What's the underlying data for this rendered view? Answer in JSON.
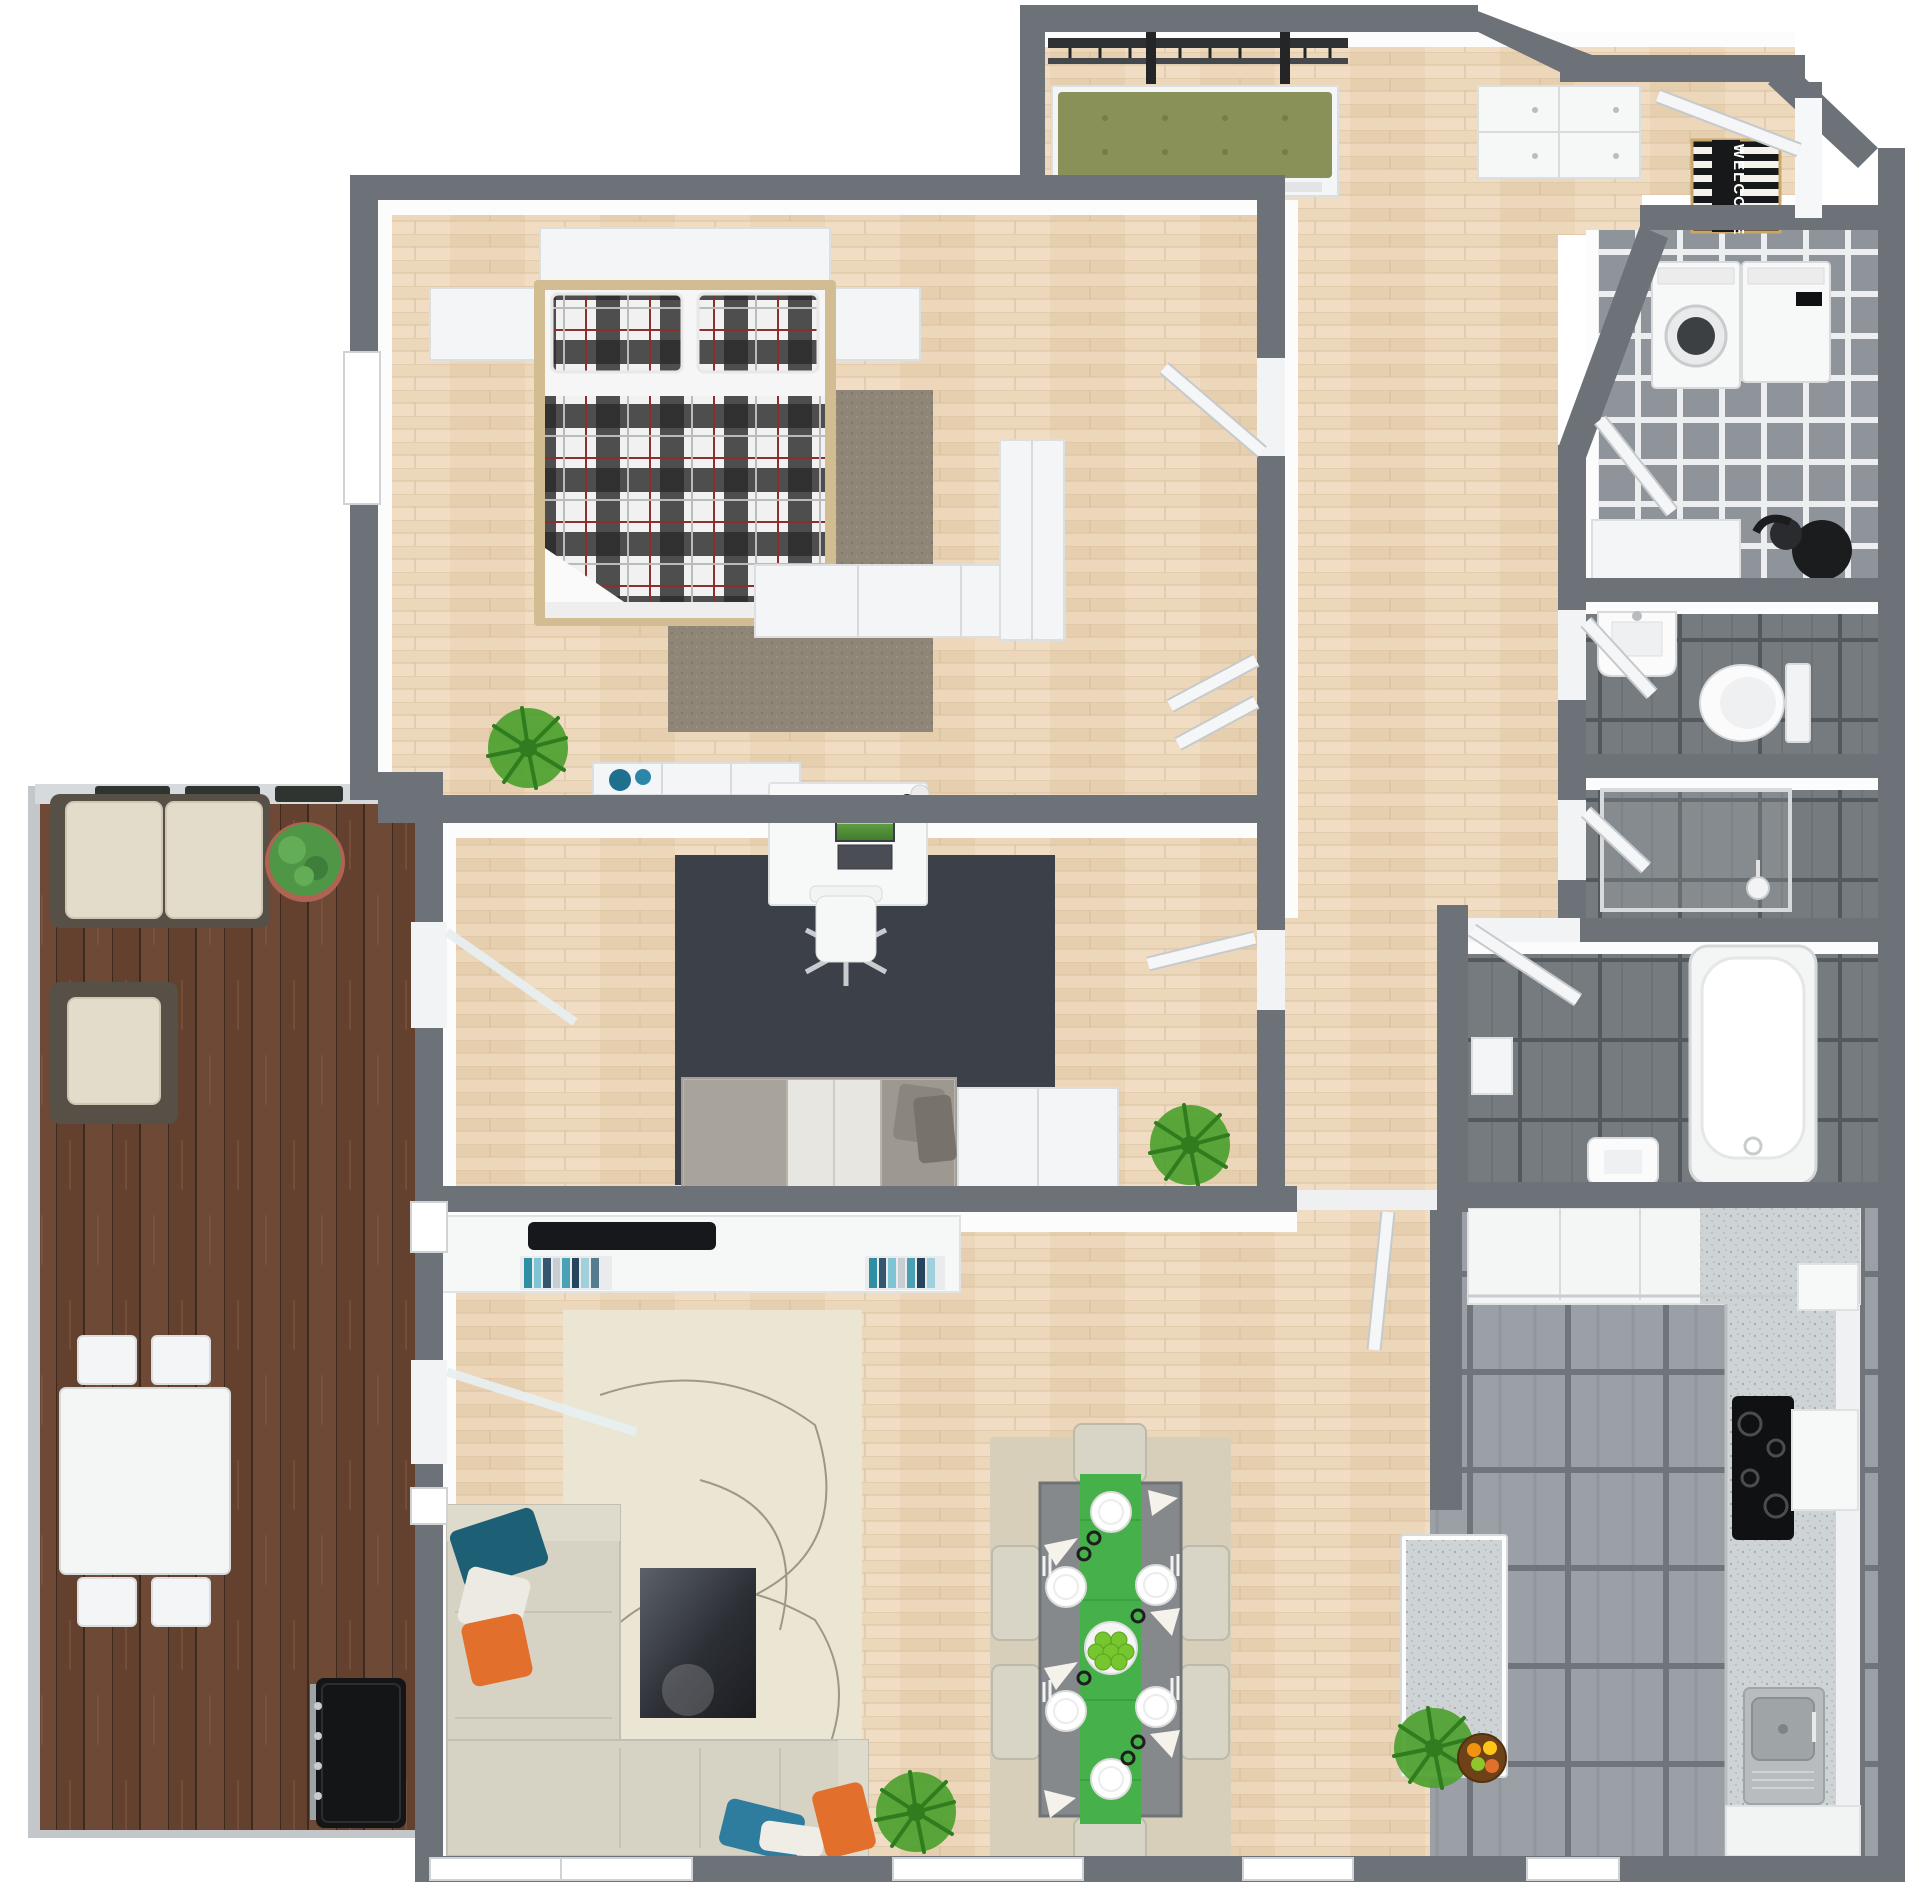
{
  "image_type": "3d-floor-plan-top-view",
  "entry": {
    "welcome_mat_text": "WELCOME"
  },
  "rooms": [
    {
      "name": "bedroom",
      "floor": "light-wood",
      "furniture": [
        "double-bed-plaid",
        "two-plaid-pillows",
        "headboard-shelf",
        "nightstand-left",
        "nightstand-right",
        "brown-area-rug",
        "potted-palm",
        "dresser-with-blue-bowls",
        "white-sideboard",
        "wardrobe",
        "closet-doors"
      ]
    },
    {
      "name": "home-office",
      "floor": "light-wood",
      "furniture": [
        "desk",
        "computer-monitor",
        "office-chair",
        "charcoal-area-rug",
        "gray-daybed-sofa",
        "storage-cabinet",
        "potted-fern"
      ]
    },
    {
      "name": "living-room",
      "floor": "light-wood",
      "furniture": [
        "tv-console",
        "tv-soundbar",
        "media-shelves-with-books",
        "cream-area-rug",
        "dark-coffee-table",
        "cream-sectional-sofa",
        "throw-pillows-teal-white-orange",
        "potted-fern"
      ]
    },
    {
      "name": "dining-area",
      "floor": "light-wood",
      "furniture": [
        "gray-dining-table",
        "green-table-runner",
        "six-cream-chairs",
        "six-place-settings",
        "green-apple-centerpiece",
        "beige-area-rug"
      ]
    },
    {
      "name": "kitchen",
      "floor": "large-gray-tile",
      "furniture": [
        "l-shaped-counter",
        "black-cooktop",
        "range-hood-cabinet",
        "stainless-sink",
        "kitchen-island",
        "fruit-bowl",
        "potted-plant"
      ]
    },
    {
      "name": "hallway",
      "floor": "light-wood",
      "furniture": [
        "interior-doors"
      ]
    },
    {
      "name": "entry",
      "floor": "light-wood",
      "furniture": [
        "coat-rack-bench-olive-cushion",
        "white-drawer-cabinet",
        "welcome-mat",
        "front-door"
      ]
    },
    {
      "name": "laundry-room",
      "floor": "small-gray-checker-tile",
      "furniture": [
        "washing-machine",
        "dryer",
        "white-counter",
        "vacuum-cleaner"
      ]
    },
    {
      "name": "wc",
      "floor": "dark-gray-tile",
      "furniture": [
        "wall-sink",
        "toilet"
      ]
    },
    {
      "name": "shower-room",
      "floor": "dark-gray-tile",
      "furniture": [
        "glass-shower-enclosure",
        "shower-head"
      ]
    },
    {
      "name": "bathroom",
      "floor": "dark-gray-tile",
      "furniture": [
        "bathtub",
        "small-sink",
        "white-shelf"
      ]
    },
    {
      "name": "balcony",
      "floor": "walnut-deck",
      "furniture": [
        "wicker-outdoor-sofa",
        "wicker-armchair",
        "white-outdoor-table",
        "four-outdoor-chairs",
        "black-grill",
        "potted-boxwood",
        "railing-planters"
      ]
    }
  ],
  "colors": {
    "wall": "#6c7277",
    "wood_floor": "#ead6b8",
    "deck": "#6e4a36",
    "tile_laundry": "#8e9499",
    "tile_dark": "#767b80",
    "tile_kitchen": "#9aa0a5",
    "counter_speckle": "#ced3d5",
    "runner_green": "#46b14a",
    "cushion_olive": "#8a9158",
    "pillow_teal": "#1d5f75",
    "pillow_orange": "#e2702c",
    "pillow_blue": "#2e7d9e",
    "sofa_cream": "#d6d2c4",
    "rug_cream": "#ebe6d4",
    "rug_office": "#3c4049",
    "rug_bedroom": "#8f8678",
    "rug_dining": "#d8cfba",
    "table_gray": "#85898c",
    "plaid_dark": "#2b2b2b",
    "plaid_red": "#8c2f2f"
  }
}
